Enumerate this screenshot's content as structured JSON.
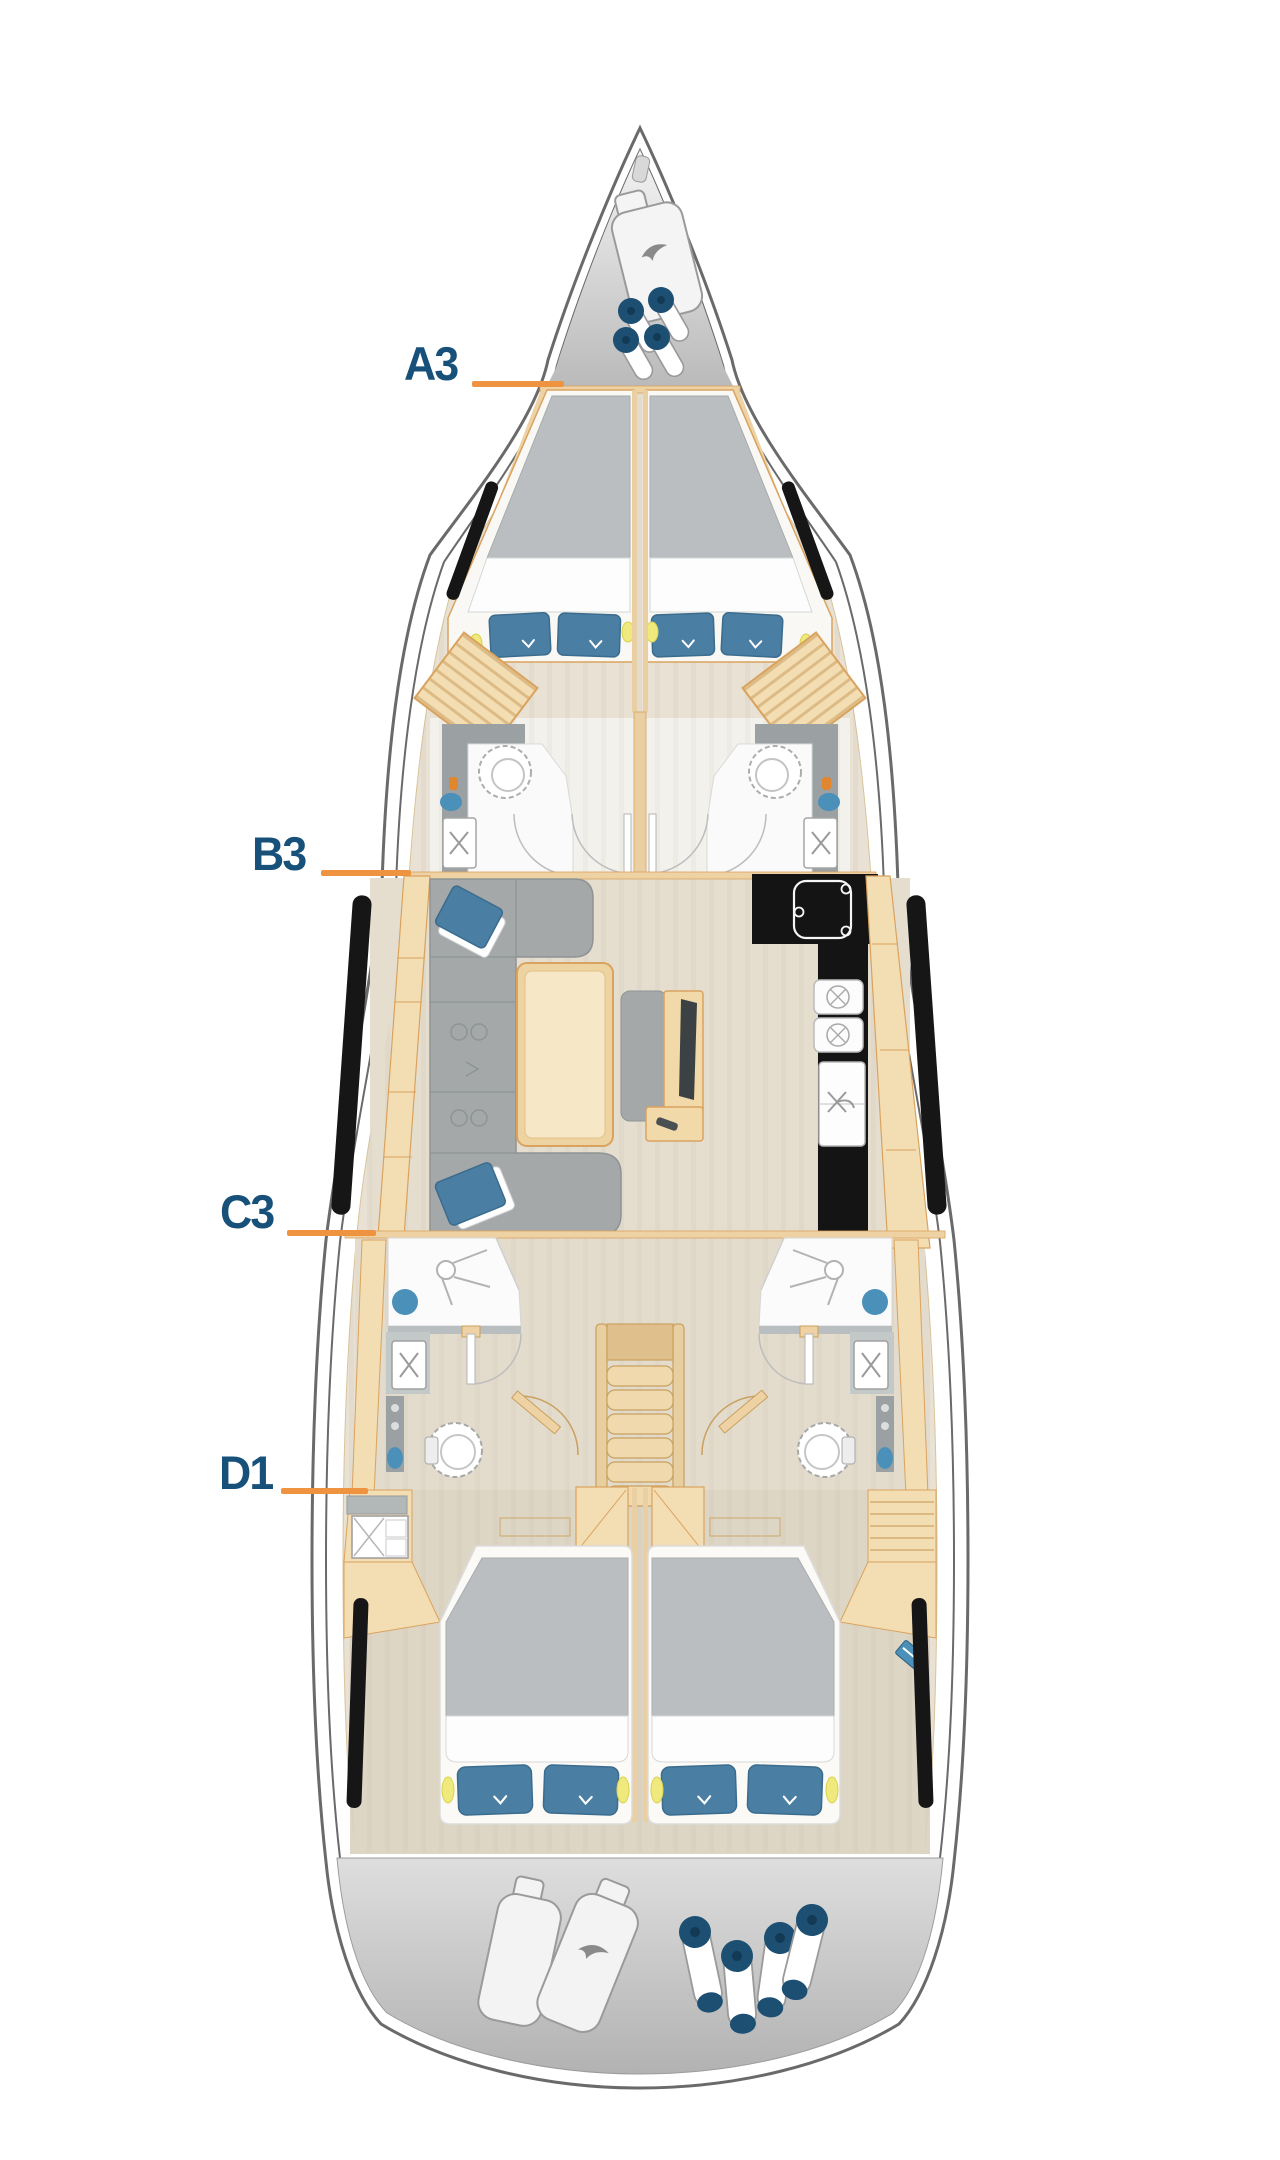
{
  "floorplan": {
    "type": "sailing-yacht-deck-plan",
    "cabin_labels": [
      {
        "label": "A3",
        "points_to": "forward-cabin"
      },
      {
        "label": "B3",
        "points_to": "saloon-port-side"
      },
      {
        "label": "C3",
        "points_to": "port-aft-bathroom"
      },
      {
        "label": "D1",
        "points_to": "port-aft-cabin"
      }
    ]
  },
  "colors": {
    "label_text": "#175078",
    "leader_line": "#ee9340",
    "hull_line": "#6a6a6a",
    "wood": "#f3ddb2",
    "wood_border": "#d9a35f",
    "floor": "#e8e1d4",
    "mattress_gray": "#babec0",
    "sofa_gray": "#a4a8a9",
    "pillow_blue": "#4a7ea3",
    "galley_black": "#141414",
    "accent_blue": "#4a90b8",
    "deck_gray": "#c6c6c6",
    "fender_navy": "#1d4f72",
    "reading_light": "#f0ea7e"
  }
}
